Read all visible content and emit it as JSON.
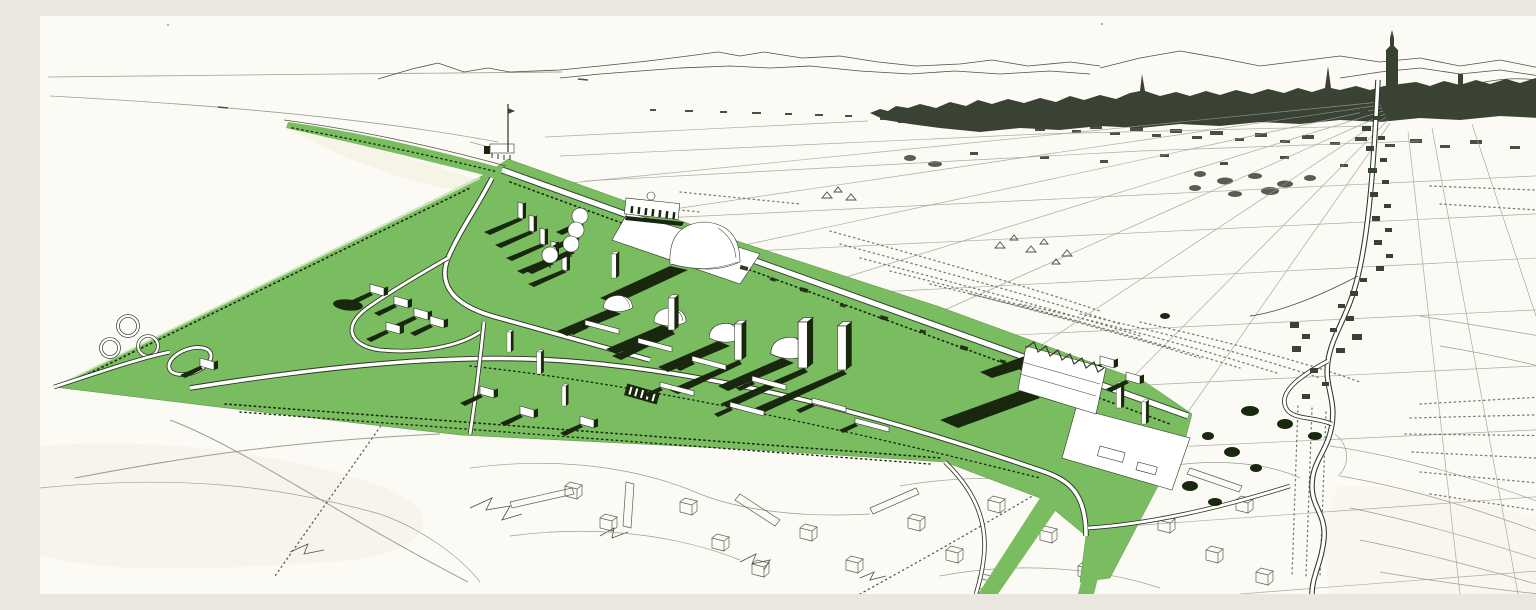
{
  "artwork": {
    "kind": "hand-drawn aerial perspective site plan",
    "style": "pen-and-ink line drawing with flat green overlay on warm white paper",
    "orientation": "landscape bird's-eye view toward a distant city on the horizon"
  },
  "palette": {
    "paper": "#fbfaf5",
    "paper_shade": "#f2edda",
    "ink": "#4b5246",
    "ink_faint": "#9aa092",
    "ink_sketch": "#5a6054",
    "ink_strong": "#2d3626",
    "city_ink": "#3a4233",
    "site_green": "#7abc60",
    "site_green_pale": "#e6f1d8",
    "shadow_green": "#19270f",
    "building_white": "#ffffff"
  },
  "scene": {
    "regions": [
      {
        "name": "sea",
        "desc": "open water upper left with faint horizon lines"
      },
      {
        "name": "far-shore-mountains",
        "desc": "thin ridge lines along the horizon"
      },
      {
        "name": "city-skyline",
        "desc": "dark dense silhouette upper right with tall cathedral spire"
      },
      {
        "name": "farm-field-grid",
        "desc": "perspective parcel lines converging toward the city"
      },
      {
        "name": "dune-scrub-band",
        "desc": "stippled dotted band between site and fields"
      },
      {
        "name": "highway-to-city",
        "desc": "outlined road descending from the city with hairpin bend"
      },
      {
        "name": "village-ribbon",
        "desc": "small dark houses strung along the highway"
      },
      {
        "name": "green-master-plan-site",
        "desc": "large green wedge pointing left, filled with new buildings"
      },
      {
        "name": "shoreline-promenade",
        "desc": "narrow green strip with tree dots along the beach"
      },
      {
        "name": "observation-mast",
        "desc": "tall mast with flag at the shoreline point"
      },
      {
        "name": "grand-mall-avenue",
        "desc": "straight white esplanade crossing the site"
      },
      {
        "name": "exhibition-domes",
        "desc": "one large dome and a descending row of medium domes"
      },
      {
        "name": "mushroom-pavilions",
        "desc": "diagonal row of four small umbrella domes"
      },
      {
        "name": "slab-towers",
        "desc": "white high-rise slabs casting long shadows"
      },
      {
        "name": "radiating-avenues",
        "desc": "dark avenues fanning out from a plaza"
      },
      {
        "name": "cloverleaf-interchange",
        "desc": "looping white roads at the left of the site"
      },
      {
        "name": "reflecting-pond",
        "desc": "small dark oval pond"
      },
      {
        "name": "factory-sawtooth",
        "desc": "large shed with sawtooth roof on the right of the site"
      },
      {
        "name": "existing-suburb-sketch",
        "desc": "outline-only cubes and slabs below the site"
      },
      {
        "name": "contour-meadows",
        "desc": "sweeping contour curves lower right"
      }
    ],
    "counts": {
      "large_domes": 1,
      "medium_domes": 4,
      "mushroom_pavilions": 4,
      "slab_towers": 4,
      "thin_slab_row": 5
    }
  }
}
